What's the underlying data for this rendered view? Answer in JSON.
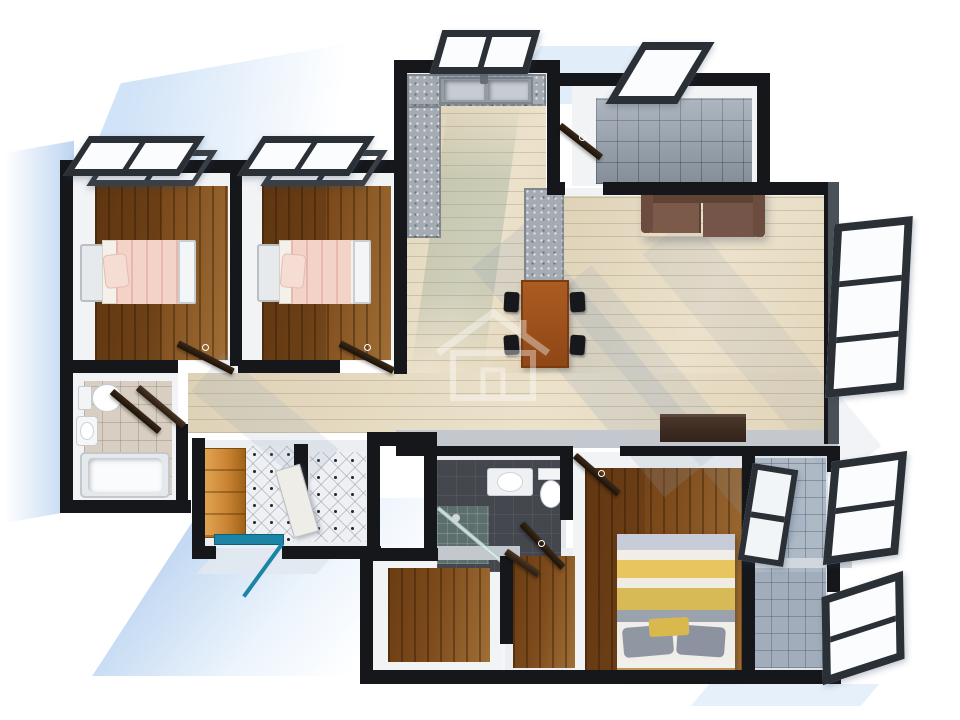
{
  "scene": {
    "title": "3D rendered apartment floor plan, top-down view",
    "style": "architectural 3D render",
    "background": "#ffffff"
  },
  "palette": {
    "wall": "#15171b",
    "wall_face": "#c3c8cf",
    "wall_side_grey": "#4a5158",
    "shadow_blue": "#bcd3ef",
    "wood_dark_a": "#6b3d13",
    "wood_dark_b": "#a06f36",
    "wood_light_a": "#ddd1b6",
    "wood_light_b": "#ece2cc",
    "granite": "#a4abb3",
    "tile_grey": "#9aa5b1",
    "tile_blue": "#aeb9c6",
    "charcoal": "#44484e",
    "beige_tile": "#d8cfc2",
    "diamond_tile": "#eef0f4",
    "teal_door": "#1c84a4",
    "sofa": "#6e4c3d",
    "dining_table": "#a0521d",
    "tv_cabinet": "#3f2d24",
    "bed_blanket_pink": "#f3d2c7",
    "bed_yellow": "#e9c55f",
    "bed_grey": "#9aa2ae",
    "wardrobe": "#c98433",
    "fixture": "#f4f6f8",
    "window_frame": "#2b3036"
  },
  "rooms": [
    {
      "id": "bedroom-1",
      "floor": "dark-wood",
      "furniture": [
        "single-bed-pink"
      ]
    },
    {
      "id": "bedroom-2",
      "floor": "dark-wood",
      "furniture": [
        "single-bed-pink"
      ]
    },
    {
      "id": "bathroom-1",
      "floor": "beige-tile",
      "furniture": [
        "toilet",
        "washbasin",
        "bathtub"
      ]
    },
    {
      "id": "hallway",
      "floor": "light-wood",
      "furniture": []
    },
    {
      "id": "entry",
      "floor": "diamond-tile",
      "furniture": [
        "wardrobe"
      ],
      "door": "teal-entrance-door-open"
    },
    {
      "id": "kitchen",
      "floor": "light-wood",
      "furniture": [
        "granite-counter",
        "double-sink",
        "granite-pillar"
      ]
    },
    {
      "id": "utility-room",
      "floor": "grey-tile",
      "furniture": []
    },
    {
      "id": "living-dining",
      "floor": "light-wood",
      "furniture": [
        "sofa",
        "dining-table",
        "4-chairs",
        "tv-cabinet"
      ]
    },
    {
      "id": "master-bathroom",
      "floor": "charcoal-tile",
      "furniture": [
        "washbasin",
        "toilet",
        "glass-shower"
      ]
    },
    {
      "id": "small-room",
      "floor": "dark-wood",
      "furniture": []
    },
    {
      "id": "corridor",
      "floor": "dark-wood",
      "furniture": []
    },
    {
      "id": "master-bedroom",
      "floor": "dark-wood",
      "furniture": [
        "double-bed-striped"
      ]
    },
    {
      "id": "balcony",
      "floor": "blue-grey-tile",
      "furniture": [
        "shelf"
      ]
    }
  ],
  "openings": {
    "entrance": "teal framed door shown open",
    "open_windows": 8,
    "interior_doors": 7
  },
  "watermark": {
    "shape": "house-outline-logo",
    "color": "#ffffff",
    "opacity": 0.38
  }
}
